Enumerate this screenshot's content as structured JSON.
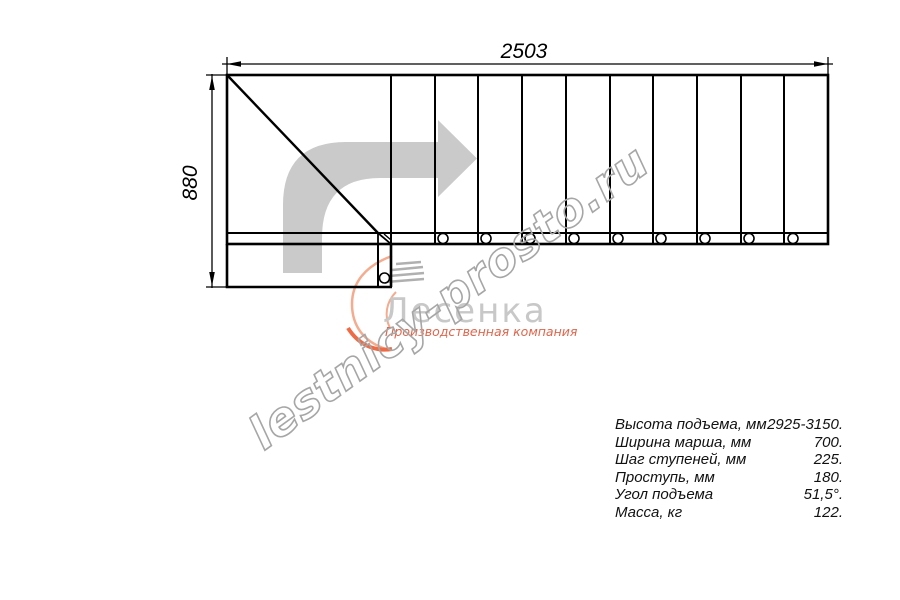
{
  "drawing": {
    "dimensions": {
      "top": "2503",
      "left": "880"
    },
    "watermark": {
      "text": "lestnicy-prosto.ru"
    },
    "logo": {
      "name": "Лесенка",
      "tagline": "Производственная компания"
    },
    "specs": {
      "rows": [
        {
          "label": "Высота подъема, мм",
          "value": "2925-3150."
        },
        {
          "label": "Ширина марша, мм",
          "value": "700."
        },
        {
          "label": "Шаг ступеней, мм",
          "value": "225."
        },
        {
          "label": "Проступь, мм",
          "value": "180."
        },
        {
          "label": "Угол подъема",
          "value": "51,5°."
        },
        {
          "label": "Масса, кг",
          "value": "122."
        }
      ]
    },
    "colors": {
      "line": "#000000",
      "direction_arrow": "#cacaca",
      "watermark": "#a6a6a6",
      "logo_gray": "#c8c8c8",
      "logo_orange": "#ee6b45",
      "logo_tagline": "#e2644a"
    }
  }
}
